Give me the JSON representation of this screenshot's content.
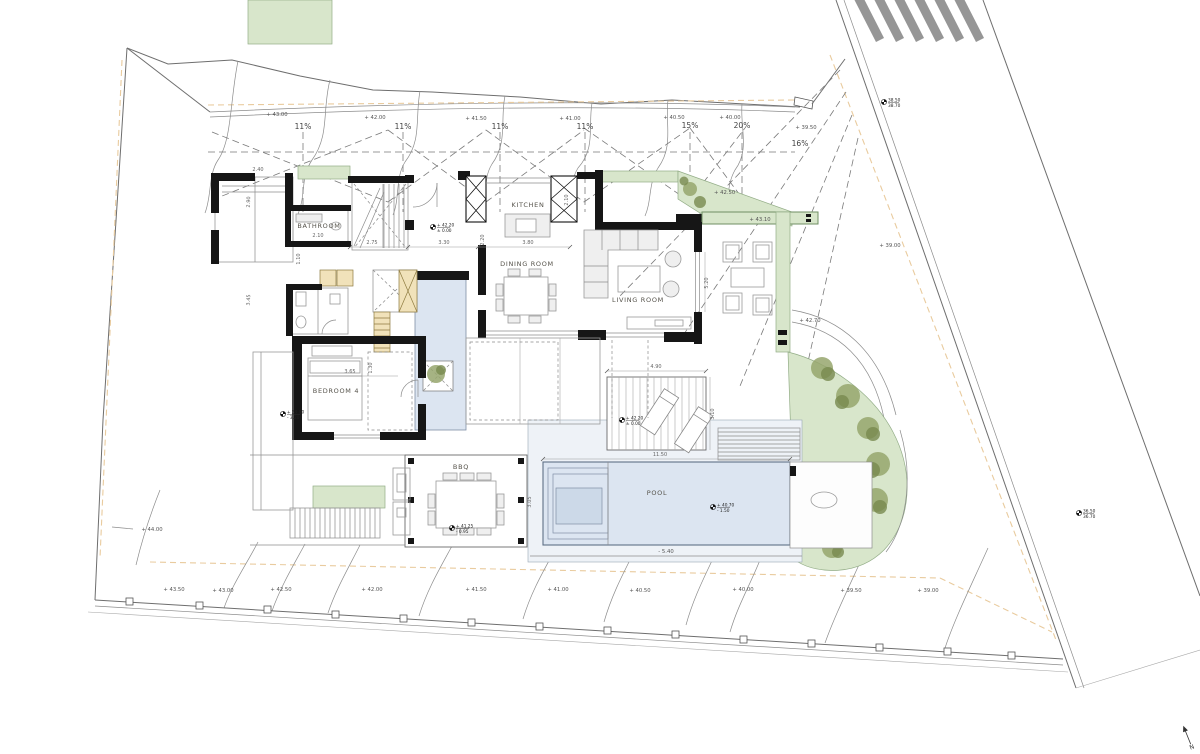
{
  "rooms": {
    "kitchen": "KITCHEN",
    "dining": "DINING ROOM",
    "living": "LIVING ROOM",
    "bathroom": "BATHROOM",
    "bedroom4": "BEDROOM 4",
    "bbq": "BBQ",
    "pool": "POOL"
  },
  "slopes": {
    "s1": "11%",
    "s2": "11%",
    "s3": "11%",
    "s4": "11%",
    "s5": "15%",
    "s6": "20%",
    "s7": "16%"
  },
  "contours_top": {
    "c1": "+ 43.00",
    "c2": "+ 42.00",
    "c3": "+ 41.50",
    "c4": "+ 41.00",
    "c5": "+ 40.50",
    "c6": "+ 40.00",
    "c7": "+ 39.50"
  },
  "contours_bottom": {
    "c1": "+ 43.50",
    "c2": "+ 43.00",
    "c3": "+ 42.50",
    "c4": "+ 42.00",
    "c5": "+ 41.50",
    "c6": "+ 41.00",
    "c7": "+ 40.50",
    "c8": "+ 40.00",
    "c9": "+ 39.50",
    "c10": "+ 39.00"
  },
  "site_levels": {
    "west": "+ 44.00",
    "east": "+ 39.00",
    "path": "+ 42.70",
    "planter": "+ 42.50",
    "planter_bar": "+ 43.10",
    "pool_apron": "- 5.40"
  },
  "level_markers": {
    "entry": {
      "abs": "+ 42.20",
      "rel": "± 0.00"
    },
    "deck": {
      "abs": "+ 42.20",
      "rel": "± 0.00"
    },
    "bbq": {
      "abs": "+ 41.25",
      "rel": "- 0.95"
    },
    "pool": {
      "abs": "+ 40.70",
      "rel": "- 1.50"
    },
    "west_terrace": {
      "abs": "+ 39.00",
      "rel": "- 3.20"
    },
    "road_upper": {
      "abs": "38.50",
      "rel": "38.70"
    },
    "road_lower": {
      "abs": "36.50",
      "rel": "36.70"
    }
  },
  "dimensions": {
    "hall": "2.75",
    "entry": "3.30",
    "foyer": "2.20",
    "kitchen_w": "3.80",
    "bath_w": "2.10",
    "kitchen_d": "2.10",
    "bed_w": "3.65",
    "bed_d": "1.30",
    "deck_w": "4.90",
    "deck_d": "3.10",
    "pool_w": "11.50",
    "pool_d": "3.05",
    "living_d": "5.20",
    "block_a": "2.90",
    "block_b": "3.45",
    "block_c": "1.10",
    "block_d": "2.40"
  },
  "compass": {
    "north": "N"
  },
  "colors": {
    "planter_green": "#d8e6cb",
    "tree_green": "#78894f",
    "water_blue": "#dce5f1",
    "pool_apron_blue": "#eef2f7",
    "joinery_tan": "#f1e2ba",
    "wall_black": "#161616",
    "setback_dash_orange": "#e9cb9e",
    "line_gray": "#6e6e6e"
  }
}
